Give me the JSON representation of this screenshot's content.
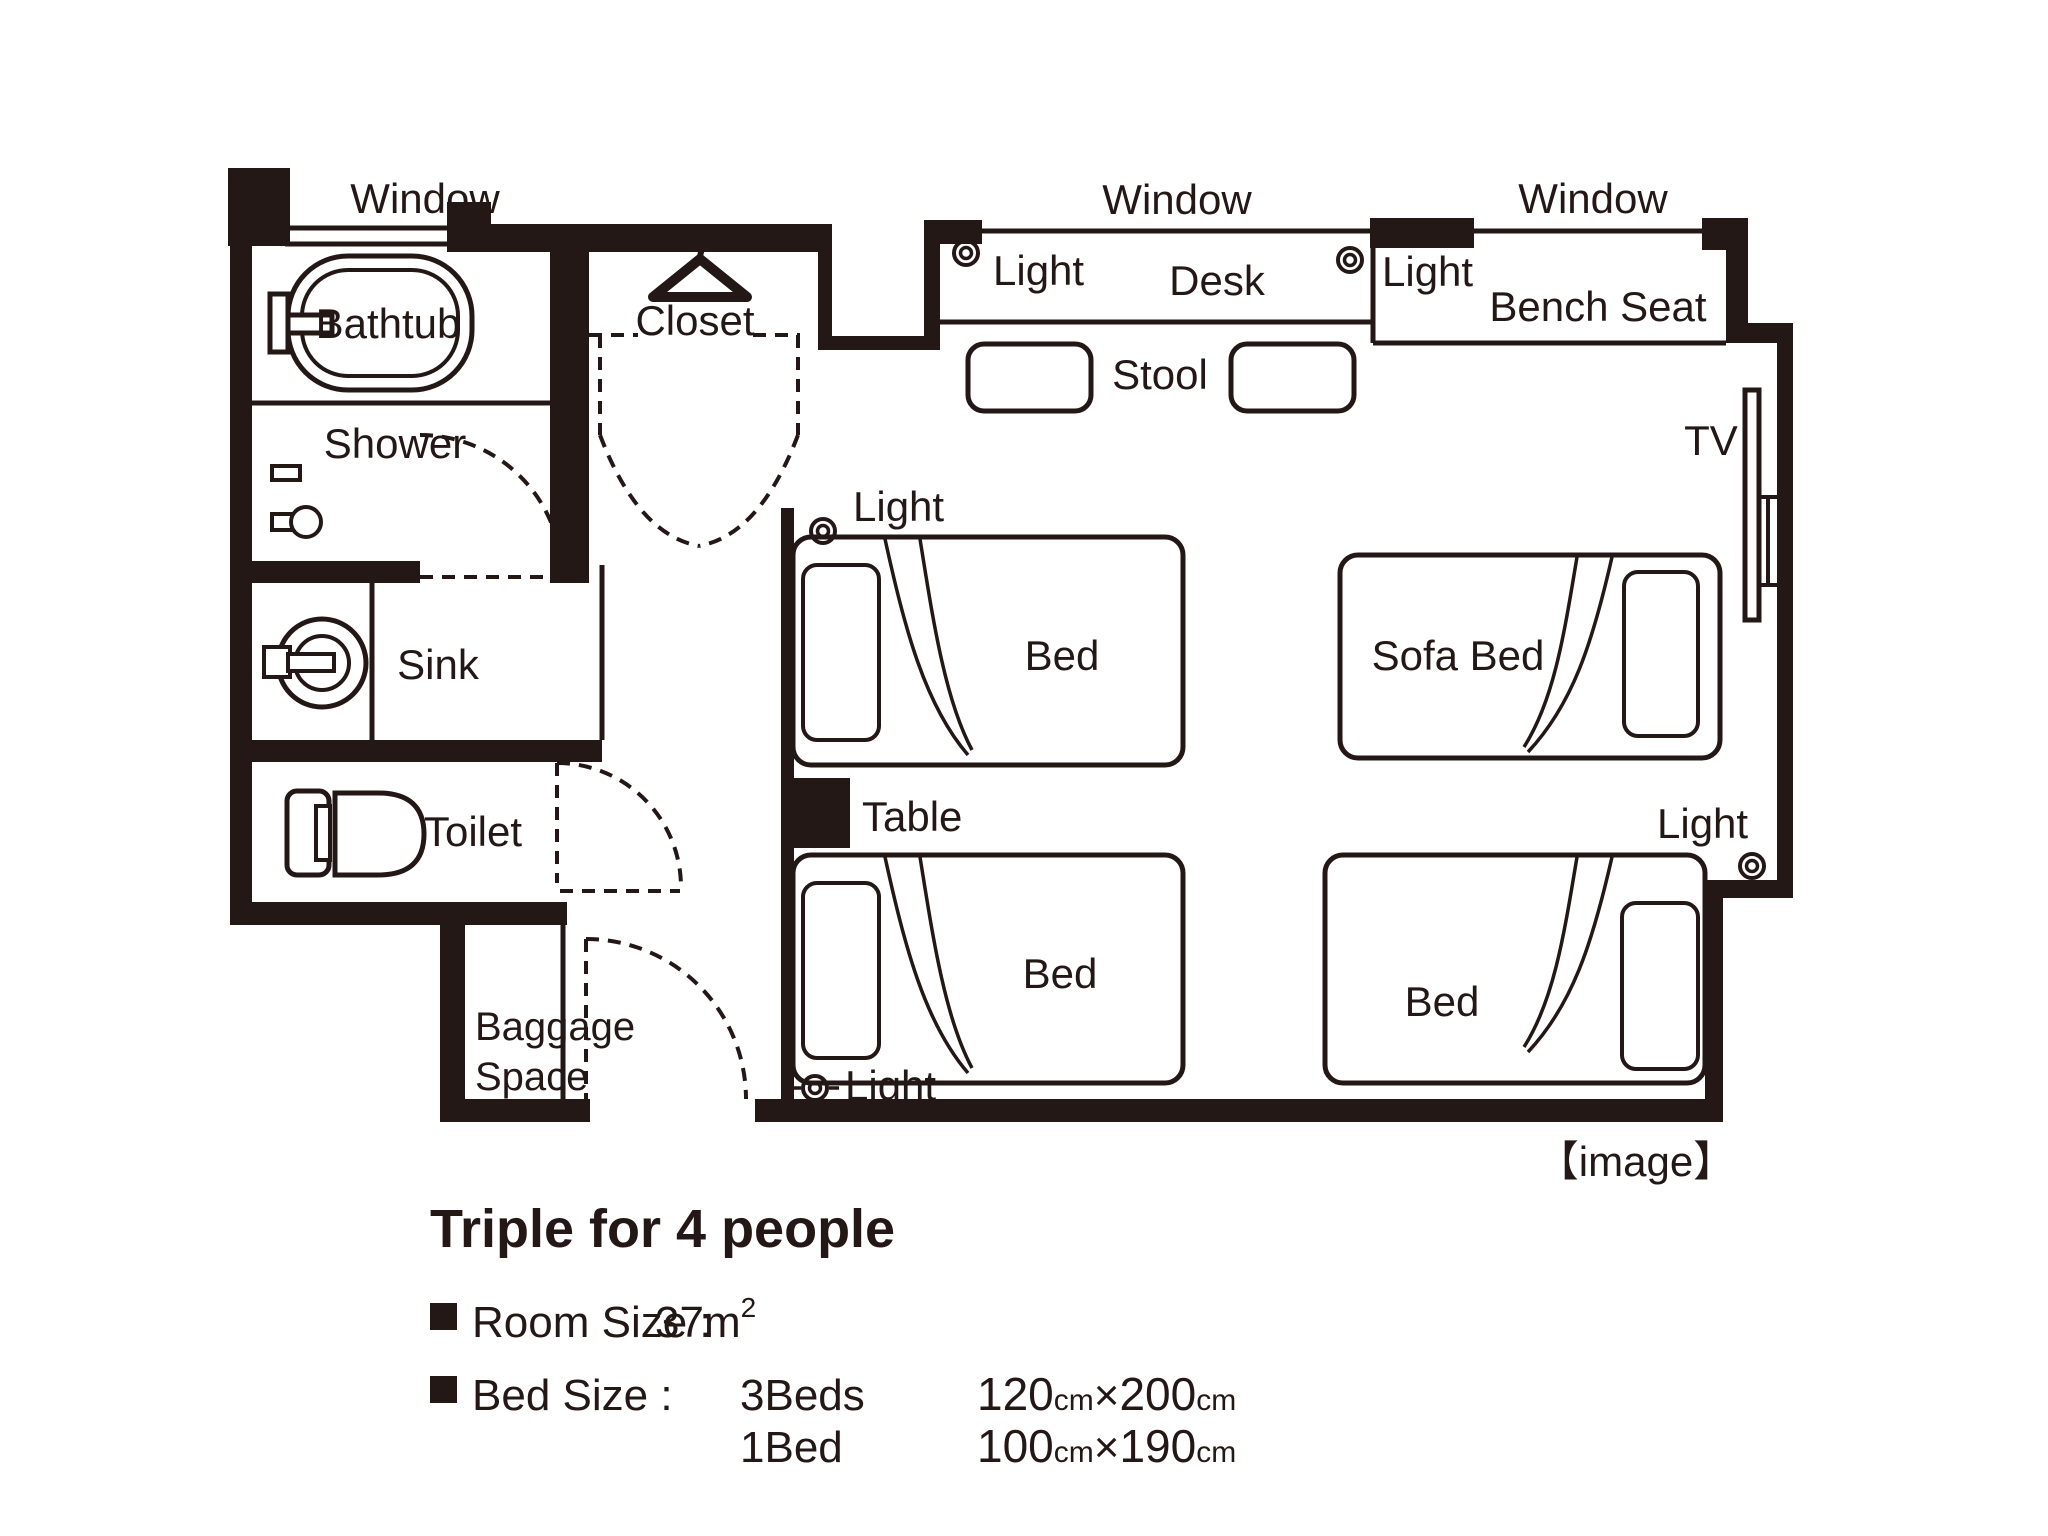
{
  "colors": {
    "ink": "#231815",
    "bg": "#ffffff"
  },
  "plan": {
    "windows": [
      {
        "label": "Window"
      },
      {
        "label": "Window"
      },
      {
        "label": "Window"
      }
    ],
    "lights": [
      {
        "label": "Light"
      },
      {
        "label": "Light"
      },
      {
        "label": "Light"
      },
      {
        "label": "Light"
      },
      {
        "label": "Light"
      }
    ],
    "rooms": {
      "bathtub": "Bathtub",
      "shower": "Shower",
      "sink": "Sink",
      "toilet": "Toilet",
      "closet": "Closet",
      "baggage_space": {
        "line1": "Baggage",
        "line2": "Space"
      }
    },
    "furniture": {
      "desk": "Desk",
      "stool": "Stool",
      "bench_seat": "Bench Seat",
      "tv": "TV",
      "table": "Table",
      "sofa_bed": "Sofa Bed",
      "beds": [
        {
          "label": "Bed"
        },
        {
          "label": "Bed"
        },
        {
          "label": "Bed"
        }
      ]
    },
    "caption": "【image】"
  },
  "details": {
    "title": "Triple for 4 people",
    "room_size": {
      "label": "Room Size :",
      "value": "37m",
      "sup": "2"
    },
    "bed_size": {
      "label": "Bed Size :",
      "rows": [
        {
          "count": "3Beds",
          "width": "120",
          "unit1": "cm",
          "times": "×",
          "length": "200",
          "unit2": "cm"
        },
        {
          "count": "1Bed",
          "width": "100",
          "unit1": "cm",
          "times": "×",
          "length": "190",
          "unit2": "cm"
        }
      ]
    }
  }
}
